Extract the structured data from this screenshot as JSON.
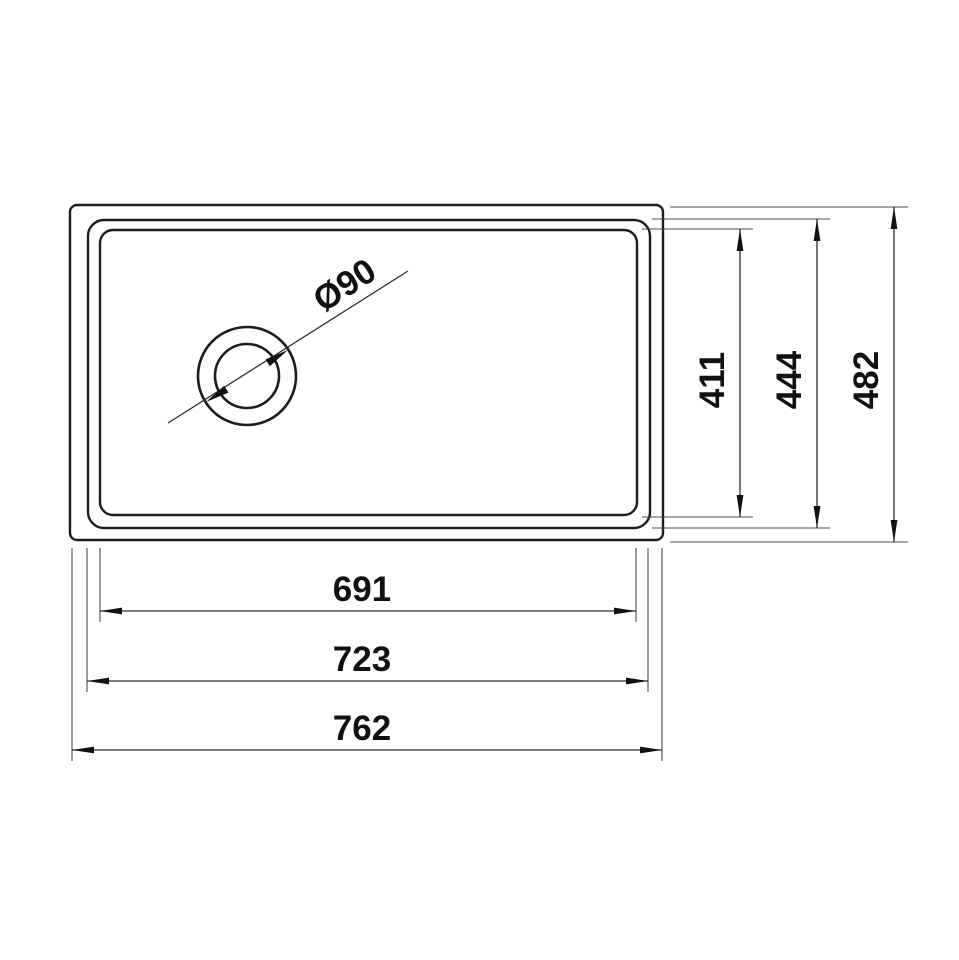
{
  "drawing": {
    "subject": "Sink top-view technical dimension drawing",
    "drain_diameter_label": "Ø90",
    "width_dimensions": [
      {
        "label": "691"
      },
      {
        "label": "723"
      },
      {
        "label": "762"
      }
    ],
    "height_dimensions": [
      {
        "label": "411"
      },
      {
        "label": "444"
      },
      {
        "label": "482"
      }
    ],
    "colors": {
      "background": "#ffffff",
      "outline": "#1c1c1c",
      "dimension_line": "#2e2e2e",
      "extension_line": "#4d4d4d",
      "text": "#111111"
    }
  }
}
